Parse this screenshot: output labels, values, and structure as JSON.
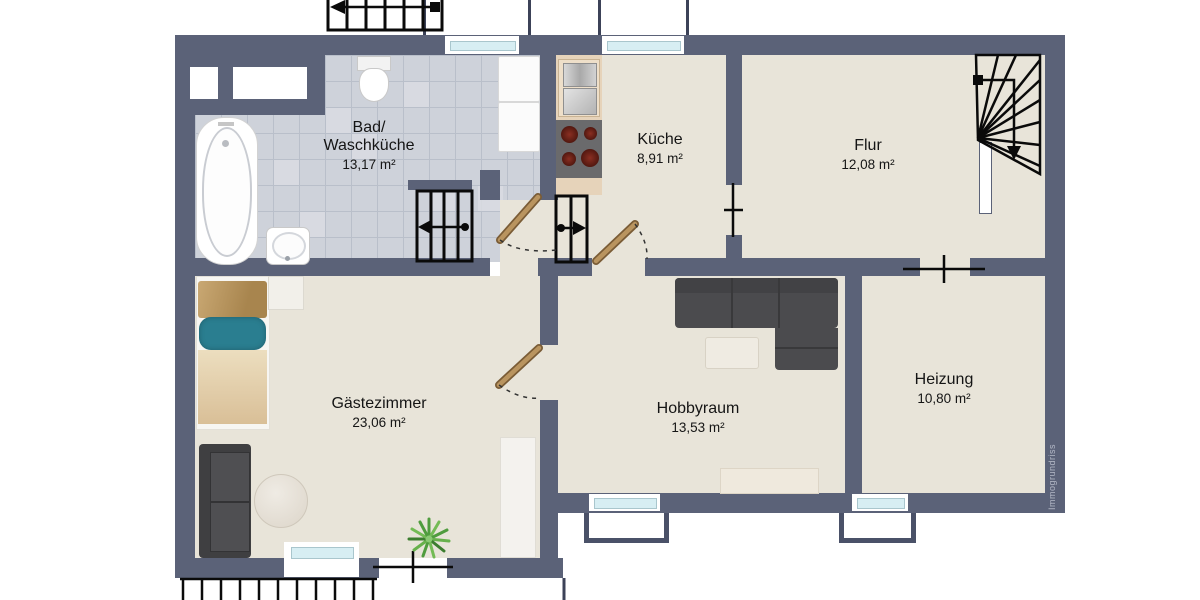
{
  "plan": {
    "watermark": "Immogrundriss",
    "rooms": [
      {
        "name": "Bad/",
        "name2": "Waschküche",
        "area": "13,17 m²"
      },
      {
        "name": "Küche",
        "area": "8,91 m²"
      },
      {
        "name": "Flur",
        "area": "12,08 m²"
      },
      {
        "name": "Gästezimmer",
        "area": "23,06 m²"
      },
      {
        "name": "Hobbyraum",
        "area": "13,53 m²"
      },
      {
        "name": "Heizung",
        "area": "10,80 m²"
      }
    ],
    "fixtures": [
      "bathtub",
      "toilet",
      "hand-basin",
      "washer-dryer-stack",
      "kitchen-sink",
      "stove-top",
      "exterior-staircase",
      "interior-staircase",
      "steps",
      "winder-staircase",
      "door-swing",
      "door-symbol",
      "window",
      "light-well",
      "bed",
      "sofa",
      "corner-sofa",
      "round-table",
      "coffee-table",
      "sideboard",
      "shelf",
      "plant"
    ],
    "colors": {
      "wall": "#5b6278",
      "floor": "#e8e4d9",
      "tile": "#ced2da",
      "grout": "#b9bfca",
      "glass": "#d7eef3",
      "wood": "#b9945f",
      "woodedge": "#7a5c36",
      "sofa": "#4b4b4e",
      "pillow": "#2a7e90"
    }
  }
}
